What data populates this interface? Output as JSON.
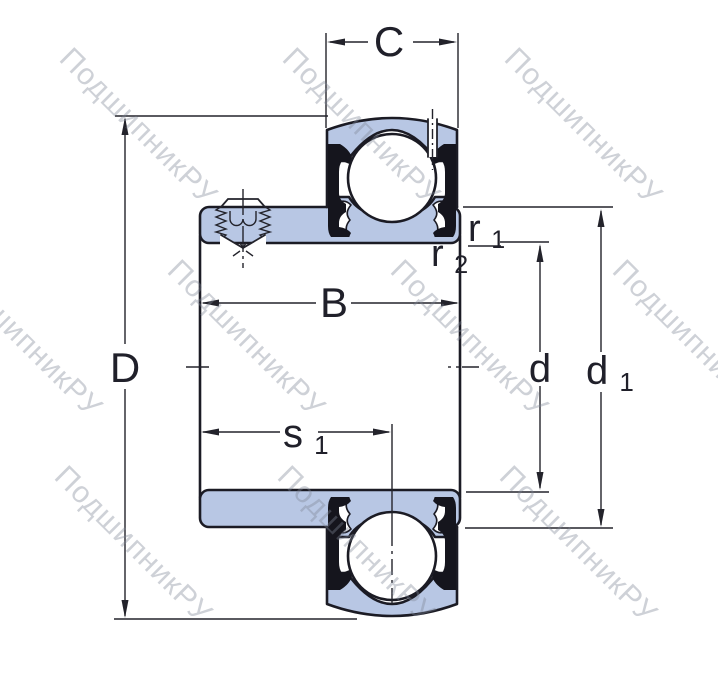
{
  "watermark": {
    "text": "ПодшипникРУ"
  },
  "colors": {
    "ring_fill": "#b8c7e4",
    "outline": "#1b1b24",
    "dimension_line": "#23232b",
    "label_text": "#20202a",
    "watermark_text": "#7d8796",
    "seal": "#15151d",
    "background": "#ffffff"
  },
  "dimension_labels": {
    "outer_ring_width": "C",
    "outer_diameter": "D",
    "inner_ring_width": "B",
    "bore_diameter": "d",
    "extension_diameter_base": "d",
    "extension_diameter_sub": "1",
    "fillet_radius_1_base": "r",
    "fillet_radius_1_sub": "1",
    "fillet_radius_2_base": "r",
    "fillet_radius_2_sub": "2",
    "locating_distance_base": "s",
    "locating_distance_sub": "1"
  }
}
